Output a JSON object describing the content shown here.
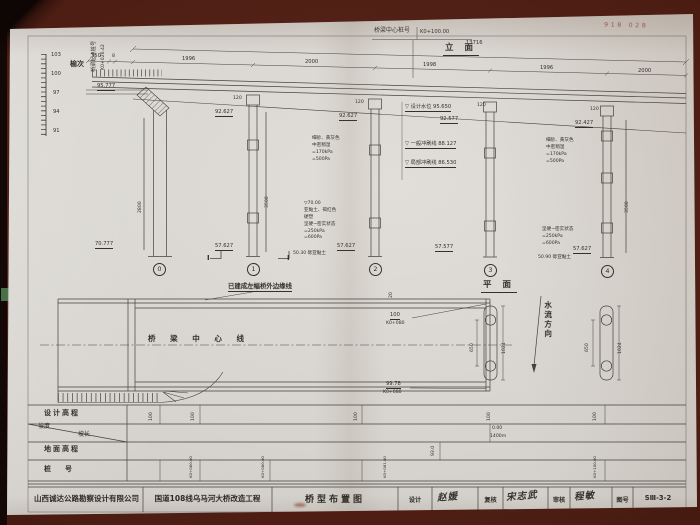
{
  "header": {
    "center_pile_label": "桥梁中心桩号",
    "center_pile_value": "K0+100.00",
    "elevation_title": "立 面",
    "plan_title": "平 面"
  },
  "stamp": {
    "number": "918 028"
  },
  "table": {
    "design_elev_label": "设计高程",
    "slope_label": "坡度",
    "slope_length_label": "坡长",
    "ground_elev_label": "地面高程",
    "pile_number_label": "桩　　号"
  },
  "titleblock": {
    "company": "山西诚达公路勘察设计有限公司",
    "project": "国道108线乌马河大桥改造工程",
    "drawing_name": "桥型布置图",
    "design_label": "设计",
    "design_signature": "赵媛",
    "check_label": "复核",
    "check_signature": "宋志武",
    "review_label": "审核",
    "review_signature": "程敏",
    "number_label": "图号",
    "number_value": "SⅢ-3-2"
  },
  "labels": [
    {
      "n": "scale-103",
      "t": "103",
      "x": 51,
      "y": 53,
      "c": "t5"
    },
    {
      "n": "scale-100",
      "t": "100",
      "x": 51,
      "y": 72,
      "c": "t5"
    },
    {
      "n": "scale-97",
      "t": "97",
      "x": 53,
      "y": 91,
      "c": "t5"
    },
    {
      "n": "scale-94",
      "t": "94",
      "x": 53,
      "y": 110,
      "c": "t5"
    },
    {
      "n": "scale-91",
      "t": "91",
      "x": 53,
      "y": 129,
      "c": "t5"
    },
    {
      "n": "direction-yuci",
      "t": "榆次",
      "x": 70,
      "y": 60,
      "c": "t7b"
    },
    {
      "n": "bridge-start-label",
      "t": "桥梁起点桩号",
      "x": 92,
      "y": 72,
      "c": "rot t5"
    },
    {
      "n": "bridge-start-value",
      "t": "K0+026.42",
      "x": 101,
      "y": 70,
      "c": "rot t45"
    },
    {
      "n": "abutment-top-elevation",
      "t": "95.777",
      "x": 97,
      "y": 84,
      "c": "t5 u"
    },
    {
      "n": "abutment-bottom-elevation",
      "t": "70.777",
      "x": 95,
      "y": 242,
      "c": "t5 u"
    },
    {
      "n": "abutment-height-dim",
      "t": "2800",
      "x": 138,
      "y": 213,
      "c": "rot t45"
    },
    {
      "n": "pier0-number",
      "t": "0",
      "x": 153,
      "y": 263,
      "c": "circ"
    },
    {
      "n": "dim-total",
      "t": "13716",
      "x": 466,
      "y": 41,
      "c": "t5"
    },
    {
      "n": "dim-350",
      "t": "350",
      "x": 91,
      "y": 54,
      "c": "t5"
    },
    {
      "n": "dim-8",
      "t": "8",
      "x": 112,
      "y": 54,
      "c": "t45"
    },
    {
      "n": "dim-span1",
      "t": "1996",
      "x": 182,
      "y": 57,
      "c": "t5"
    },
    {
      "n": "dim-span2",
      "t": "2000",
      "x": 305,
      "y": 60,
      "c": "t5"
    },
    {
      "n": "dim-span3",
      "t": "1998",
      "x": 423,
      "y": 63,
      "c": "t5"
    },
    {
      "n": "dim-span4",
      "t": "1996",
      "x": 540,
      "y": 66,
      "c": "t5"
    },
    {
      "n": "dim-span5",
      "t": "2000",
      "x": 638,
      "y": 69,
      "c": "t5"
    },
    {
      "n": "pier1-width-dim",
      "t": "120",
      "x": 233,
      "y": 96,
      "c": "t45"
    },
    {
      "n": "pier2-width-dim",
      "t": "120",
      "x": 355,
      "y": 100,
      "c": "t45"
    },
    {
      "n": "pier3-width-dim",
      "t": "120",
      "x": 477,
      "y": 103,
      "c": "t45"
    },
    {
      "n": "pier4-width-dim",
      "t": "120",
      "x": 590,
      "y": 107,
      "c": "t45"
    },
    {
      "n": "pier1-top-elevation",
      "t": "92.627",
      "x": 215,
      "y": 110,
      "c": "t5 u"
    },
    {
      "n": "pier2-top-elevation",
      "t": "92.627",
      "x": 339,
      "y": 114,
      "c": "t5 u"
    },
    {
      "n": "pier3-top-elevation",
      "t": "92.577",
      "x": 440,
      "y": 117,
      "c": "t5 u"
    },
    {
      "n": "pier4-top-elevation",
      "t": "92.427",
      "x": 575,
      "y": 121,
      "c": "t5 u"
    },
    {
      "n": "pier1-bottom-elevation",
      "t": "57.627",
      "x": 215,
      "y": 244,
      "c": "t5 u"
    },
    {
      "n": "pier2-bottom-elevation",
      "t": "57.627",
      "x": 337,
      "y": 244,
      "c": "t5 u"
    },
    {
      "n": "pier3-bottom-elevation",
      "t": "57.577",
      "x": 435,
      "y": 245,
      "c": "t5 u"
    },
    {
      "n": "pier4-bottom-elevation",
      "t": "57.627",
      "x": 573,
      "y": 247,
      "c": "t5 u"
    },
    {
      "n": "pier1-number",
      "t": "1",
      "x": 247,
      "y": 263,
      "c": "circ"
    },
    {
      "n": "pier2-number",
      "t": "2",
      "x": 369,
      "y": 263,
      "c": "circ"
    },
    {
      "n": "pier3-number",
      "t": "3",
      "x": 484,
      "y": 264,
      "c": "circ"
    },
    {
      "n": "pier4-number",
      "t": "4",
      "x": 601,
      "y": 265,
      "c": "circ"
    },
    {
      "n": "pier1-pile-dim",
      "t": "3500",
      "x": 265,
      "y": 208,
      "c": "rot t45"
    },
    {
      "n": "pier4-pile-dim",
      "t": "3500",
      "x": 625,
      "y": 213,
      "c": "rot t45"
    },
    {
      "n": "section-mark-left",
      "t": "Ⅰ",
      "x": 207,
      "y": 254,
      "c": "t7b"
    },
    {
      "n": "section-mark-right",
      "t": "Ⅰ",
      "x": 287,
      "y": 254,
      "c": "t7b"
    },
    {
      "n": "design-water-level",
      "t": "▽ 设计水位 95.650",
      "x": 405,
      "y": 105,
      "c": "t5 u"
    },
    {
      "n": "general-scour-line",
      "t": "▽ 一般冲刷线 88.127",
      "x": 405,
      "y": 142,
      "c": "t5 u"
    },
    {
      "n": "local-scour-line",
      "t": "▽ 局部冲刷线 86.530",
      "x": 405,
      "y": 161,
      "c": "t5 u"
    },
    {
      "n": "soil-note-1",
      "t": "细砂、黄灰色\n中密稍湿\n=170kPa\n=500Pa",
      "x": 312,
      "y": 136,
      "c": "soil"
    },
    {
      "n": "soil-note-2",
      "t": "▽70.00\n亚黏土、褐红色\n硬塑\n坚硬~密实状态\n=250kPa\n=600Pa",
      "x": 304,
      "y": 201,
      "c": "soil"
    },
    {
      "n": "soil-note-3",
      "t": "细砂、黄灰色\n中密稍湿\n=170kPa\n=500Pa",
      "x": 546,
      "y": 138,
      "c": "soil"
    },
    {
      "n": "soil-note-4",
      "t": "坚硬~密实状态\n=250kPa\n=600Pa",
      "x": 542,
      "y": 227,
      "c": "soil"
    },
    {
      "n": "stratum-note-1",
      "t": "50.30 砾亚黏土",
      "x": 293,
      "y": 251,
      "c": "soil"
    },
    {
      "n": "stratum-note-2",
      "t": "50.90 砾亚黏土",
      "x": 538,
      "y": 255,
      "c": "soil"
    },
    {
      "n": "built-edge-label",
      "t": "已建成左幅桥外边缘线",
      "x": 228,
      "y": 283,
      "c": "t6b u"
    },
    {
      "n": "bridge-centerline-label",
      "t": "桥 梁 中 心 线",
      "x": 148,
      "y": 335,
      "c": "t7sp"
    },
    {
      "n": "plan-elev-top",
      "t": "100",
      "x": 390,
      "y": 313,
      "c": "t5 u"
    },
    {
      "n": "plan-station-top",
      "t": "K0+080",
      "x": 386,
      "y": 321,
      "c": "t45"
    },
    {
      "n": "plan-elev-bottom",
      "t": "99.78",
      "x": 386,
      "y": 382,
      "c": "t5 u"
    },
    {
      "n": "plan-station-bottom",
      "t": "K0+080",
      "x": 383,
      "y": 390,
      "c": "t45"
    },
    {
      "n": "plan-dim-20",
      "t": "20",
      "x": 389,
      "y": 298,
      "c": "rot t45"
    },
    {
      "n": "pierplan1-spacing-dim",
      "t": "650",
      "x": 470,
      "y": 352,
      "c": "rot t45"
    },
    {
      "n": "pierplan1-length-dim",
      "t": "1024",
      "x": 502,
      "y": 354,
      "c": "rot t45"
    },
    {
      "n": "flow-direction-label",
      "t": "水流方向",
      "x": 543,
      "y": 301,
      "c": "vert"
    },
    {
      "n": "pierplan2-spacing-dim",
      "t": "650",
      "x": 585,
      "y": 352,
      "c": "rot t45"
    },
    {
      "n": "pierplan2-length-dim",
      "t": "1024",
      "x": 618,
      "y": 354,
      "c": "rot t45"
    },
    {
      "n": "design-elev-value-1",
      "t": "100",
      "x": 149,
      "y": 421,
      "c": "rot t45"
    },
    {
      "n": "design-elev-value-2",
      "t": "100",
      "x": 191,
      "y": 421,
      "c": "rot t45"
    },
    {
      "n": "design-elev-value-3",
      "t": "100",
      "x": 354,
      "y": 421,
      "c": "rot t45"
    },
    {
      "n": "design-elev-value-4",
      "t": "100",
      "x": 487,
      "y": 421,
      "c": "rot t45"
    },
    {
      "n": "design-elev-value-5",
      "t": "100",
      "x": 593,
      "y": 421,
      "c": "rot t45"
    },
    {
      "n": "slope-value",
      "t": "0.00",
      "x": 492,
      "y": 426,
      "c": "t45"
    },
    {
      "n": "slope-length-value",
      "t": "1400m",
      "x": 490,
      "y": 434,
      "c": "t45"
    },
    {
      "n": "ground-elev-value",
      "t": "93.0",
      "x": 431,
      "y": 456,
      "c": "rot t45"
    },
    {
      "n": "pile-number-value-1",
      "t": "K0+060.00",
      "x": 189,
      "y": 478,
      "c": "rot t4"
    },
    {
      "n": "pile-number-value-2",
      "t": "K0+080.00",
      "x": 261,
      "y": 478,
      "c": "rot t4"
    },
    {
      "n": "pile-number-value-3",
      "t": "K0+081.00",
      "x": 383,
      "y": 478,
      "c": "rot t4"
    },
    {
      "n": "pile-number-value-4",
      "t": "K0+100.00",
      "x": 593,
      "y": 478,
      "c": "rot t4"
    }
  ]
}
